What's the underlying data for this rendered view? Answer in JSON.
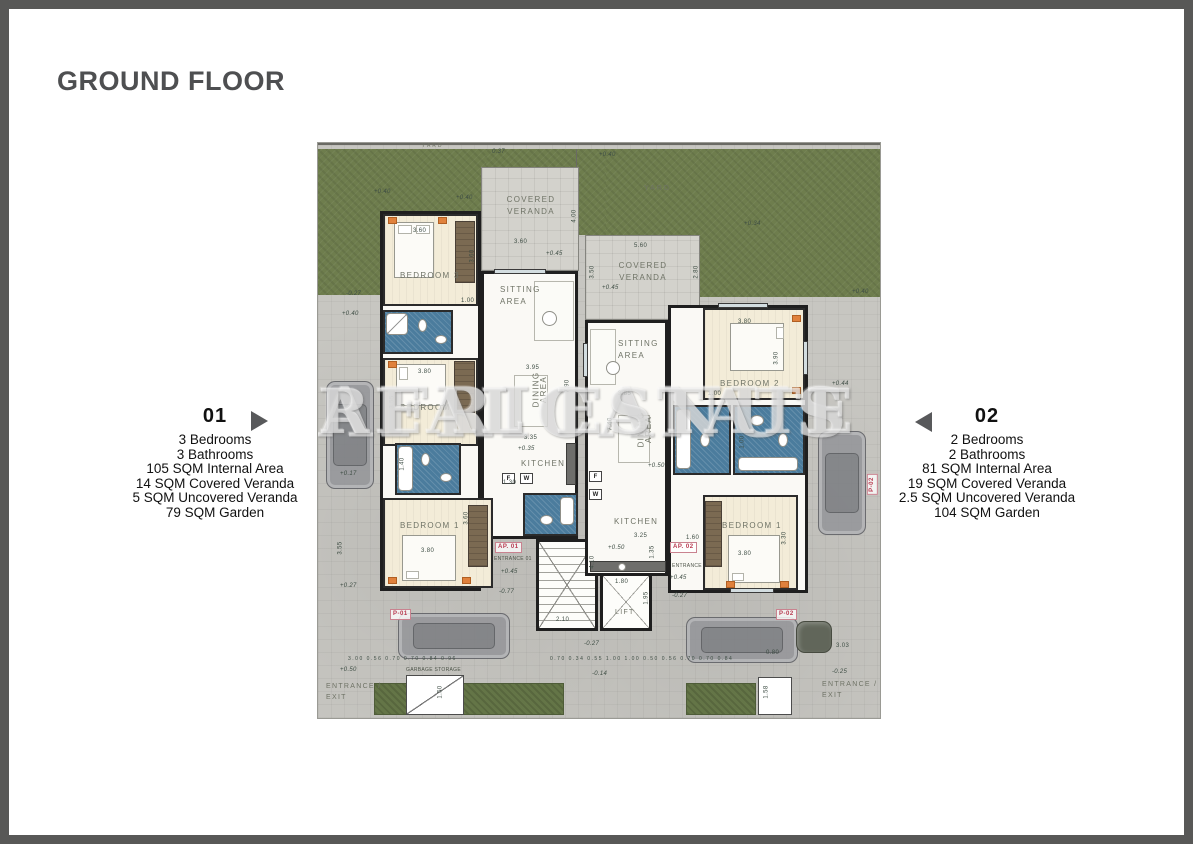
{
  "page": {
    "title": "GROUND FLOOR"
  },
  "units": [
    {
      "number": "01",
      "specs": [
        "3 Bedrooms",
        "3 Bathrooms",
        "105 SQM Internal Area",
        "14 SQM Covered Veranda",
        "5 SQM Uncovered Veranda",
        "79 SQM Garden"
      ]
    },
    {
      "number": "02",
      "specs": [
        "2 Bedrooms",
        "2 Bathrooms",
        "81 SQM Internal Area",
        "19 SQM Covered Veranda",
        "2.5 SQM Uncovered Veranda",
        "104 SQM Garden"
      ]
    }
  ],
  "watermark": {
    "line1": "AFRICANUS",
    "line2": "REAL ESTATE"
  },
  "plan": {
    "rooms": {
      "yard": "YARD",
      "covered_l1": "COVERED",
      "covered_l2": "VERANDA",
      "sitting_l1": "SITTING",
      "sitting_l2": "AREA",
      "dining_l1": "DINING",
      "dining_l2": "AREA",
      "kitchen": "KITCHEN",
      "bed1": "BEDROOM 1",
      "bed2": "BEDROOM 2",
      "bed3": "BEDROOM 3",
      "lift": "LIFT"
    },
    "tags": {
      "ap01": "AP. 01",
      "ap02": "AP. 02",
      "p01": "P-01",
      "p02": "P-02"
    },
    "misc": {
      "entrance01": "ENTRANCE 01",
      "entrance02": "ENTRANCE",
      "garbage": "GARBAGE STORAGE",
      "ee1": "ENTRANCE /",
      "ee2": "EXIT",
      "fridge": "F",
      "washer": "W"
    },
    "elev": {
      "p040": "+0.40",
      "p045": "+0.45",
      "p050": "+0.50",
      "p034": "+0.34",
      "p035": "+0.35",
      "p037": "0.37",
      "p044": "+0.44",
      "p017": "+0.17",
      "p027": "+0.27",
      "m027": "-0.27",
      "m077": "-0.77",
      "m025": "-0.25",
      "m014": "-0.14"
    },
    "dims": {
      "d360": "3.60",
      "d380": "3.80",
      "d390": "3.90",
      "d330": "3.30",
      "d355": "3.55",
      "d395": "3.95",
      "d385": "3.85",
      "d335": "3.35",
      "d325": "3.25",
      "d560": "5.60",
      "d740": "7.40",
      "d790": "7.90",
      "d100": "1.00",
      "d130": "1.30",
      "d140": "1.40",
      "d180": "1.80",
      "d195": "1.95",
      "d210": "2.10",
      "d410": "4.10",
      "d135": "1.35",
      "d150": "1.50",
      "d158": "1.58",
      "d400": "4.00",
      "d280": "2.80",
      "d350": "3.50",
      "d160": "1.60",
      "d303": "3.03",
      "d080": "0.80",
      "chain1": "3.00   0.56 0.70 0.70 0.84   0.96",
      "chain2": "0.70 0.34 0.55   1.00   1.00   0.50 0.56 0.70 0.70 0.84"
    }
  },
  "colors": {
    "frame": "#585857",
    "title": "#4e4f51",
    "arrow": "#58595b",
    "grass": "#6e7d4d",
    "stone": "#c7c6c1",
    "veranda": "#d3d2cc",
    "bath_blue": "#4b7c9d",
    "bedroom_floor": "#f3ecd8",
    "wall": "#1f1f1f",
    "tag_pink": "#b8394f"
  }
}
